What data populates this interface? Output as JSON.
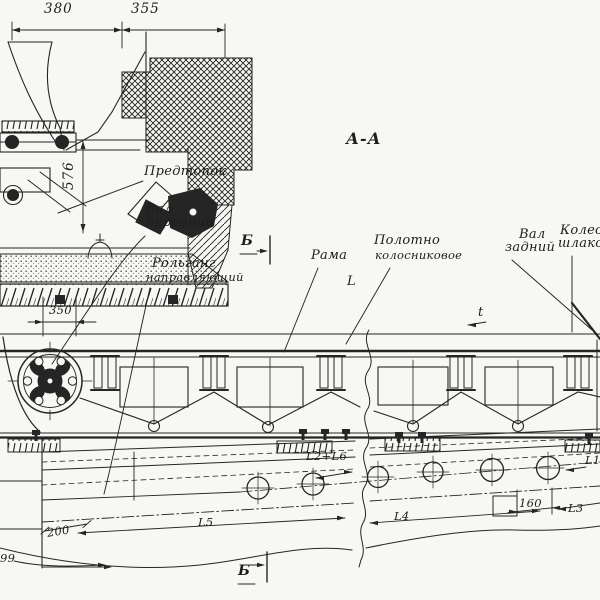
{
  "title": {
    "section": "А-А"
  },
  "labels": {
    "predtopok": "Предтопок",
    "val_peredniy_1": "Вал",
    "val_peredniy_2": "передний",
    "rolgang_1": "Рольганг",
    "rolgang_2": "направляющий",
    "rama": "Рама",
    "polotno_1": "Полотно",
    "polotno_2": "колосниковое",
    "val_zadniy_1": "Вал",
    "val_zadniy_2": "задний",
    "koleso_1": "Колесо",
    "koleso_2": "шлаковое"
  },
  "markers": {
    "b_top": "Б",
    "b_bottom": "Б"
  },
  "dims": {
    "w380": "380",
    "w355": "355",
    "h576": "576",
    "w350": "350",
    "h200": "200",
    "n99": "99",
    "n160": "160",
    "len_L": "L",
    "pitch_t": "t",
    "L1": "L1",
    "L2_L6": "L2+L6",
    "L3": "L3",
    "L4": "L4",
    "L5": "L5"
  },
  "colors": {
    "ink": "#252525",
    "paper": "#f7f7f4"
  }
}
